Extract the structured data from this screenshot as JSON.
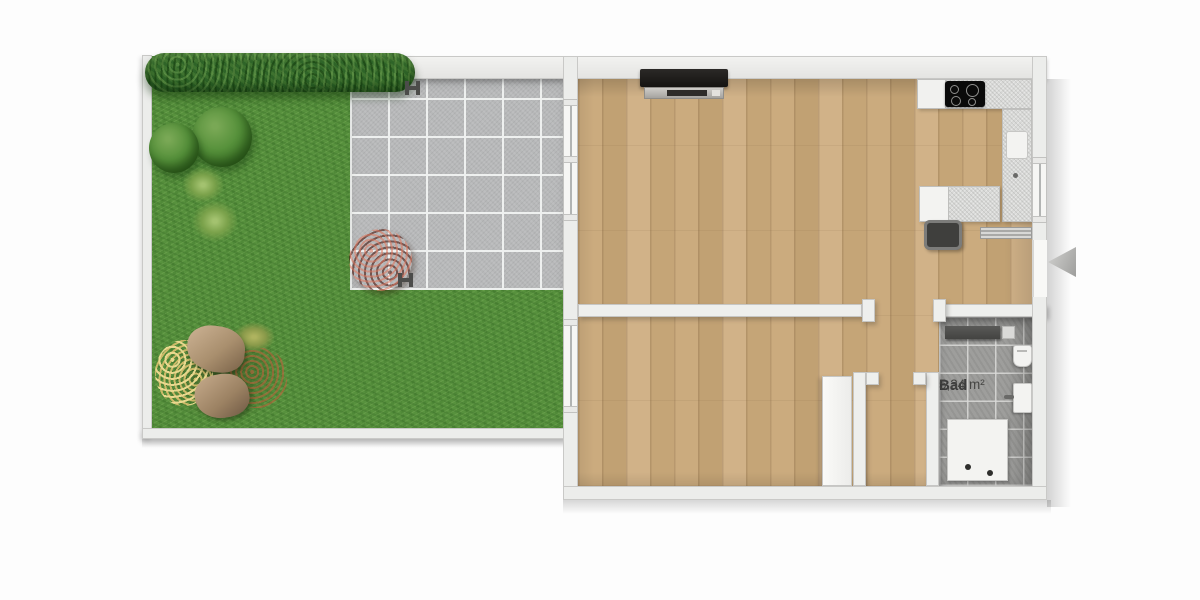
{
  "labels": {
    "bathroom_name": "Bad",
    "bathroom_area": "5,34 m²"
  },
  "colors": {
    "background": "#fdfdfd",
    "grass": "#57913d",
    "hedge": "#2f6428",
    "terrace_tile": "#b7b8b9",
    "tile_grout": "#eef0ef",
    "wall": "#ecedeb",
    "wood_floor": "#c8a87c",
    "bathroom_tile": "#9e9e9c",
    "fixture_white": "#f3f3f1",
    "cooktop_black": "#0a0a0a",
    "flower_red": "#a83c30",
    "entrance_arrow": "#b5b5b3",
    "label_text": "#3c3c3c"
  },
  "icons": {
    "entrance_arrow": "left-pointing triangle marking the apartment entrance",
    "garden_marker": "small H-shaped drain/boundary marker"
  }
}
